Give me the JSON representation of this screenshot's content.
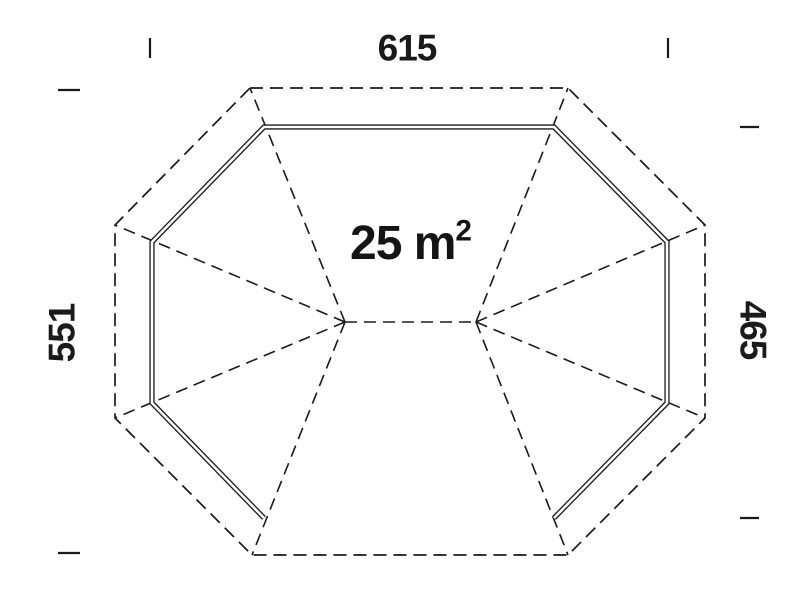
{
  "labels": {
    "width_top": "615",
    "height_left": "551",
    "height_right": "465",
    "area_value": "25 m",
    "area_superscript": "2"
  },
  "colors": {
    "line": "#1a1a1a",
    "background": "#ffffff"
  }
}
